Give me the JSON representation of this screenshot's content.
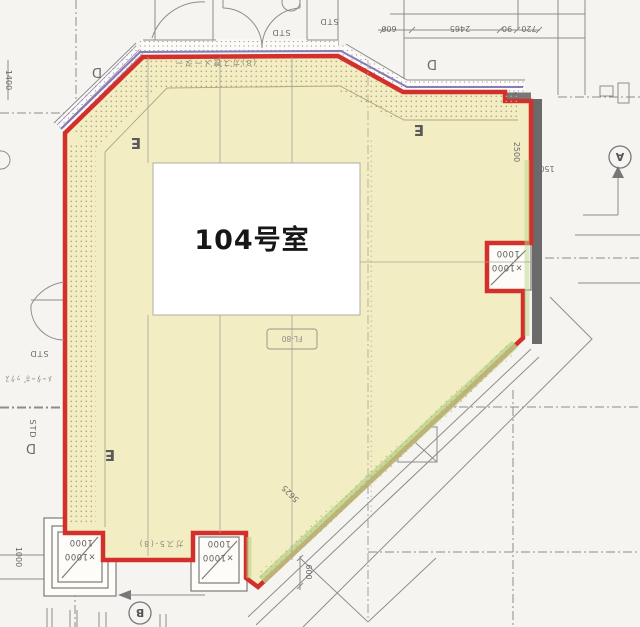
{
  "title": "104号室 平面図",
  "colors": {
    "background": "#f5f4f0",
    "room_fill": "#f2edc3",
    "outline_red": "#d4302b",
    "accent_purple": "#7a6fb0",
    "wall_dark": "#6a6a6a",
    "green_tint": "#b9d48c",
    "line_gray": "#8d8d8d",
    "stipple": "#b3a678",
    "white_band": "#fcfbf7"
  },
  "room": {
    "label": "104号室",
    "fl_label": "FL-80"
  },
  "marks": {
    "e": "E",
    "d": "D",
    "std": "STD",
    "circle_a": "A",
    "circle_b": "B"
  },
  "columns": {
    "line1": "1000",
    "line2": "×1000"
  },
  "dims": {
    "top": [
      "600",
      "2465",
      "90",
      "720"
    ],
    "right_width": "2500",
    "right_offset": "150",
    "left_height": "1400",
    "bottom_left": "1000",
    "bottom_offset": "600",
    "diagonal": "5625"
  },
  "notes": {
    "top": "(8)ガス管メーター",
    "bottom": "ガス5-(8)",
    "left": "ﾒｰﾀｰﾎﾞｯｸｽ"
  }
}
